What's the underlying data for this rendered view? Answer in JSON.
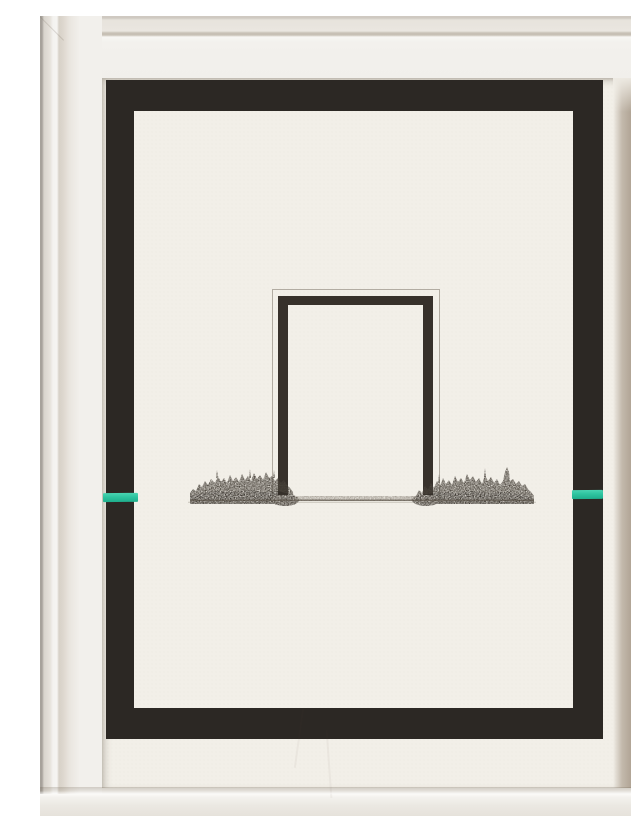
{
  "artwork": {
    "description": "Photograph of a white wooden frame holding a float-mounted cream sheet of paper. A wide hand-painted black border runs around the sheet; a bright teal dash crosses the black border at mid-height on the left and right edges. In the centre an open black portal (three-sided rectangle) stands on a finely hatched ink horizon of low vegetation, with a faint pencil outline rectangle around the portal and a thin ground line extending to both sides.",
    "colors": {
      "frame_white": "#f0ede8",
      "frame_shadow": "#ab9f90",
      "paper": "#f2efe8",
      "border_black": "#2c2824",
      "ink_black": "#37312b",
      "pencil_gray": "#7d7466",
      "accent_teal": "#2ec4a0",
      "ground_ink": "#5a5248"
    }
  }
}
